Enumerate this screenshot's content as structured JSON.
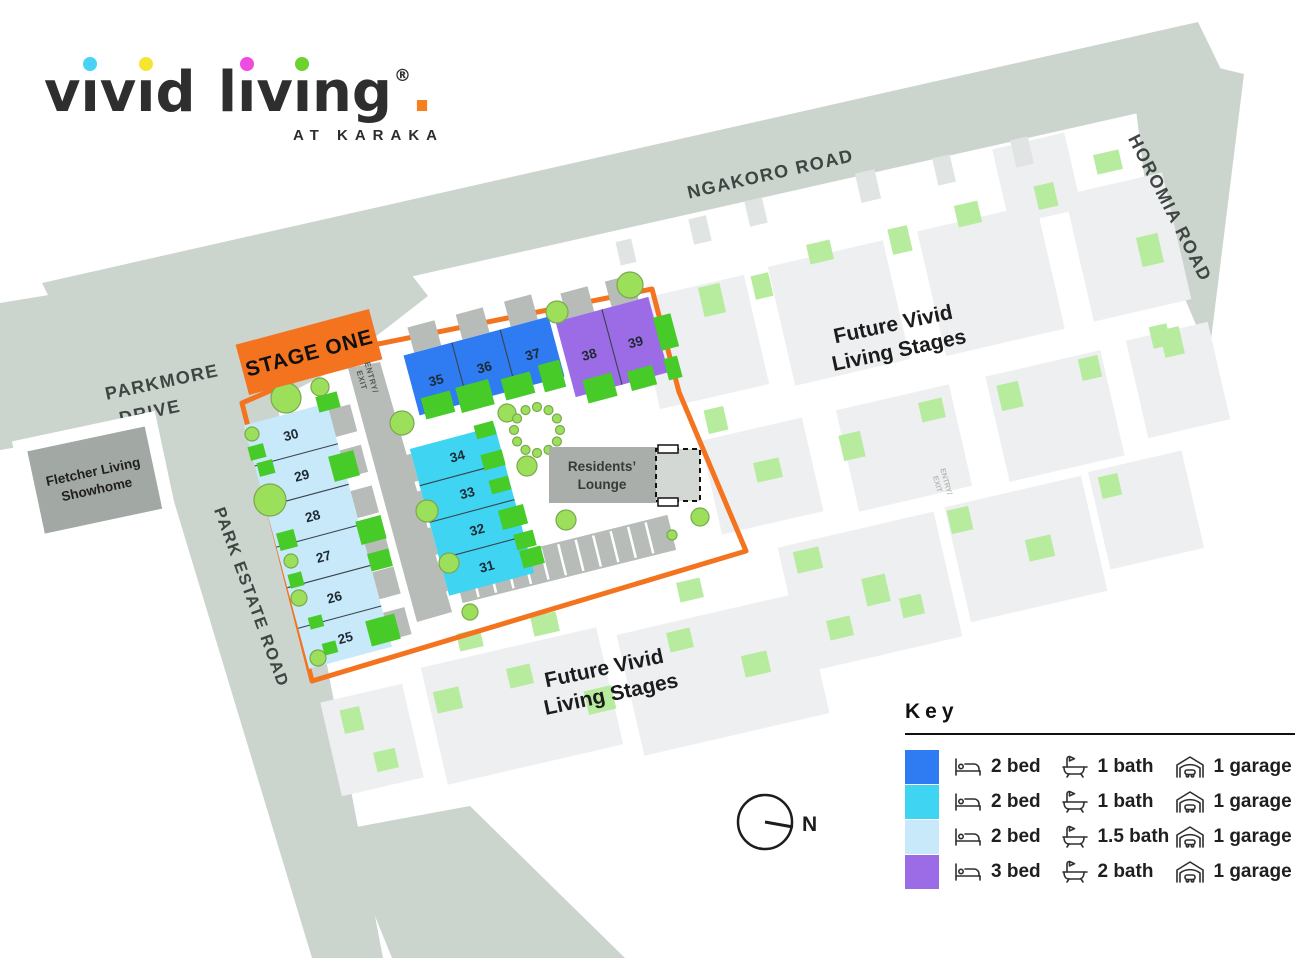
{
  "logo": {
    "letters": [
      {
        "c": "v"
      },
      {
        "c": "ı",
        "dot": "#4ad2f5"
      },
      {
        "c": "v"
      },
      {
        "c": "ı",
        "dot": "#f6e52f"
      },
      {
        "c": "d"
      },
      {
        "c": "l"
      },
      {
        "c": "ı",
        "dot": "#ee4be0"
      },
      {
        "c": "v"
      },
      {
        "c": "ı",
        "dot": "#6bd22f"
      },
      {
        "c": "n"
      },
      {
        "c": "g"
      },
      {
        "c": "®"
      },
      {
        "c": ".",
        "color": "#f5801f"
      }
    ],
    "tagline": "AT KARAKA"
  },
  "roads": {
    "ngakoro": "NGAKORO ROAD",
    "horomia": "HOROMIA ROAD",
    "parkmore_l1": "PARKMORE",
    "parkmore_l2": "DRIVE",
    "park_estate": "PARK ESTATE ROAD"
  },
  "showhome": {
    "l1": "Fletcher Living",
    "l2": "Showhome"
  },
  "banner": {
    "label": "STAGE ONE"
  },
  "entry_exit": {
    "l1": "ENTRY/",
    "l2": "EXIT"
  },
  "future_label": {
    "l1": "Future Vivid",
    "l2": "Living Stages"
  },
  "lounge": {
    "l1": "Residents’",
    "l2": "Lounge"
  },
  "lots": {
    "light_blue": [
      "30",
      "29",
      "28",
      "27",
      "26",
      "25"
    ],
    "cyan": [
      "34",
      "33",
      "32",
      "31"
    ],
    "blue": [
      "35",
      "36",
      "37"
    ],
    "purple": [
      "38",
      "39"
    ]
  },
  "compass": {
    "n": "N"
  },
  "key": {
    "title": "Key",
    "rows": [
      {
        "color": "#2e7bf2",
        "bed": "2 bed",
        "bath": "1 bath",
        "garage": "1 garage"
      },
      {
        "color": "#3fd4f2",
        "bed": "2 bed",
        "bath": "1 bath",
        "garage": "1 garage"
      },
      {
        "color": "#c8e9fa",
        "bed": "2 bed",
        "bath": "1.5 bath",
        "garage": "1 garage"
      },
      {
        "color": "#9b6ce6",
        "bed": "3 bed",
        "bath": "2 bath",
        "garage": "1 garage"
      }
    ]
  },
  "palette": {
    "accent_orange": "#f4731f",
    "road_gray": "#ccd4ce",
    "internal_road_gray": "#b7bcb9",
    "building_gray": "#a9aeab",
    "garden_green": "#46cb28",
    "tree_green": "#9cdf5b",
    "future_green": "#b7eb9e",
    "future_lot_gray": "#edeff1"
  }
}
